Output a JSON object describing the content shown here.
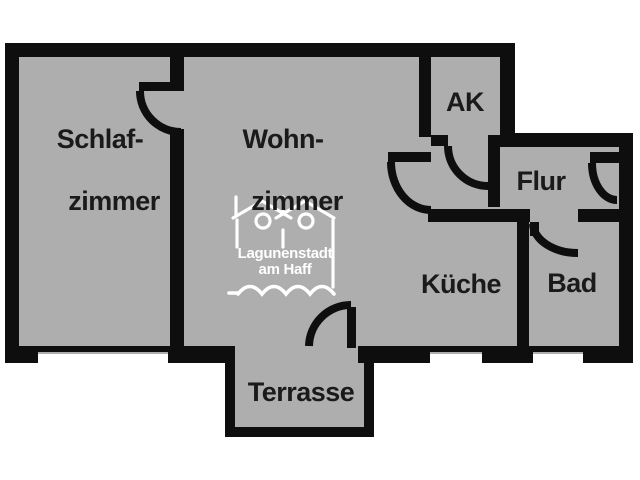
{
  "plan": {
    "type": "apartment-floorplan",
    "rooms": {
      "schlafzimmer": {
        "line1": "Schlaf-",
        "line2": "zimmer"
      },
      "wohnzimmer": {
        "line1": "Wohn-",
        "line2": "zimmer"
      },
      "ak": {
        "label": "AK"
      },
      "flur": {
        "label": "Flur"
      },
      "kueche": {
        "label": "Küche"
      },
      "bad": {
        "label": "Bad"
      },
      "terrasse": {
        "label": "Terrasse"
      }
    },
    "logo": {
      "line1": "Lagunenstadt",
      "line2": "am Haff"
    },
    "colors": {
      "background": "#ffffff",
      "floor": "#aeaeae",
      "wall": "#0e0e0e",
      "label_text": "#1a1a1a",
      "logo": "#ffffff"
    }
  }
}
